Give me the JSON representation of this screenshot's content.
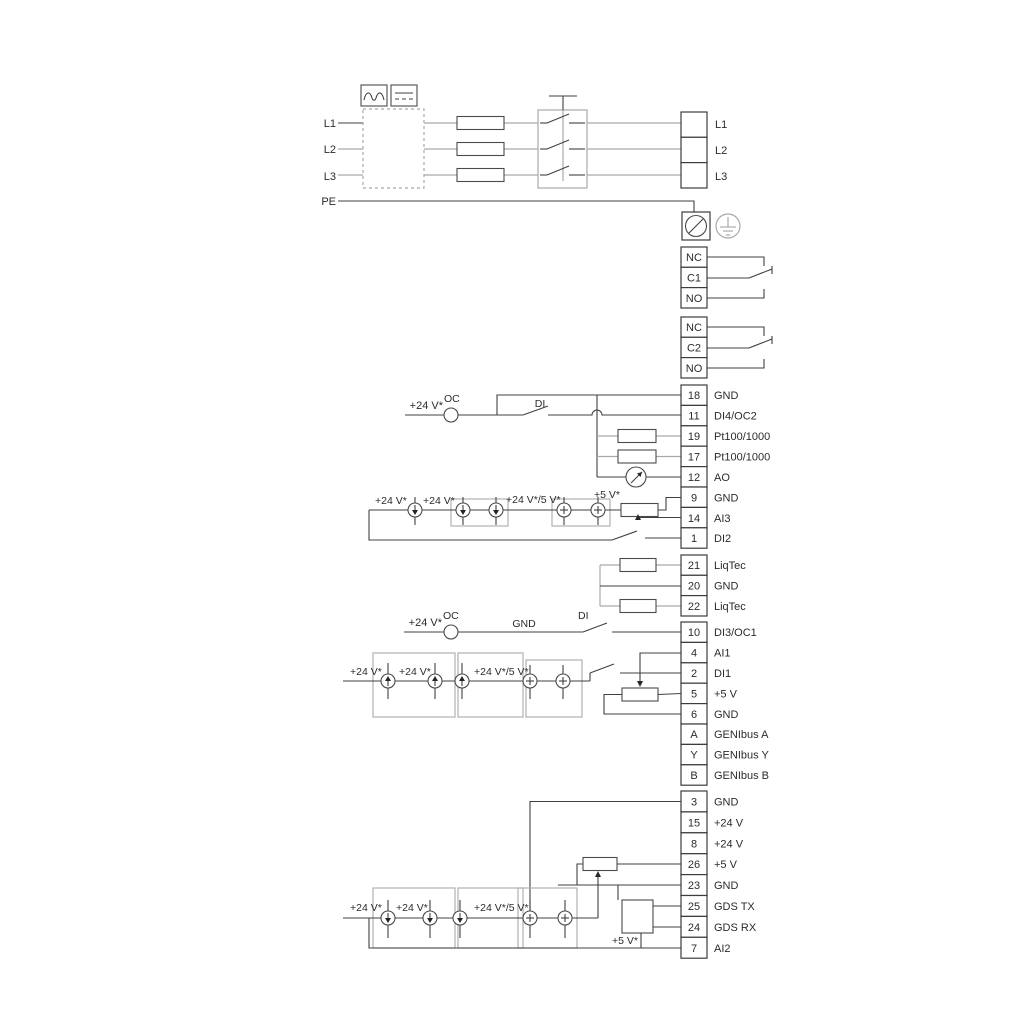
{
  "colors": {
    "wire_dark": "#404040",
    "wire_gray": "#a9a9a9",
    "text": "#2b2b2b",
    "background": "#ffffff"
  },
  "power_in": {
    "l1": "L1",
    "l2": "L2",
    "l3": "L3",
    "pe": "PE"
  },
  "power_out": {
    "l1": "L1",
    "l2": "L2",
    "l3": "L3"
  },
  "relay1": {
    "nc": "NC",
    "c": "C1",
    "no": "NO"
  },
  "relay2": {
    "nc": "NC",
    "c": "C2",
    "no": "NO"
  },
  "strip_upper": {
    "rows": [
      {
        "num": "18",
        "label": "GND"
      },
      {
        "num": "11",
        "label": "DI4/OC2"
      },
      {
        "num": "19",
        "label": "Pt100/1000"
      },
      {
        "num": "17",
        "label": "Pt100/1000"
      },
      {
        "num": "12",
        "label": "AO"
      },
      {
        "num": "9",
        "label": "GND"
      },
      {
        "num": "14",
        "label": "AI3"
      },
      {
        "num": "1",
        "label": "DI2"
      }
    ]
  },
  "strip_liqtec": {
    "rows": [
      {
        "num": "21",
        "label": "LiqTec"
      },
      {
        "num": "20",
        "label": "GND"
      },
      {
        "num": "22",
        "label": "LiqTec"
      }
    ]
  },
  "strip_genibus": {
    "rows": [
      {
        "num": "10",
        "label": "DI3/OC1"
      },
      {
        "num": "4",
        "label": "AI1"
      },
      {
        "num": "2",
        "label": "DI1"
      },
      {
        "num": "5",
        "label": "+5 V"
      },
      {
        "num": "6",
        "label": "GND"
      },
      {
        "num": "A",
        "label": "GENIbus A"
      },
      {
        "num": "Y",
        "label": "GENIbus Y"
      },
      {
        "num": "B",
        "label": "GENIbus B"
      }
    ]
  },
  "strip_bottom": {
    "rows": [
      {
        "num": "3",
        "label": "GND"
      },
      {
        "num": "15",
        "label": "+24 V"
      },
      {
        "num": "8",
        "label": "+24 V"
      },
      {
        "num": "26",
        "label": "+5 V"
      },
      {
        "num": "23",
        "label": "GND"
      },
      {
        "num": "25",
        "label": "GDS TX"
      },
      {
        "num": "24",
        "label": "GDS RX"
      },
      {
        "num": "7",
        "label": "AI2"
      }
    ]
  },
  "sec_a": {
    "supply": "+24 V*",
    "oc": "OC",
    "di": "DI",
    "v24_1": "+24 V*",
    "v24_2": "+24 V*",
    "v245": "+24 V*/5 V*",
    "v5": "+5 V*"
  },
  "sec_b": {
    "supply": "+24 V*",
    "oc": "OC",
    "gnd": "GND",
    "di": "DI",
    "v24_1": "+24 V*",
    "v24_2": "+24 V*",
    "v245": "+24 V*/5 V*"
  },
  "sec_d": {
    "v24_1": "+24 V*",
    "v24_2": "+24 V*",
    "v245": "+24 V*/5 V*",
    "v5": "+5 V*"
  }
}
